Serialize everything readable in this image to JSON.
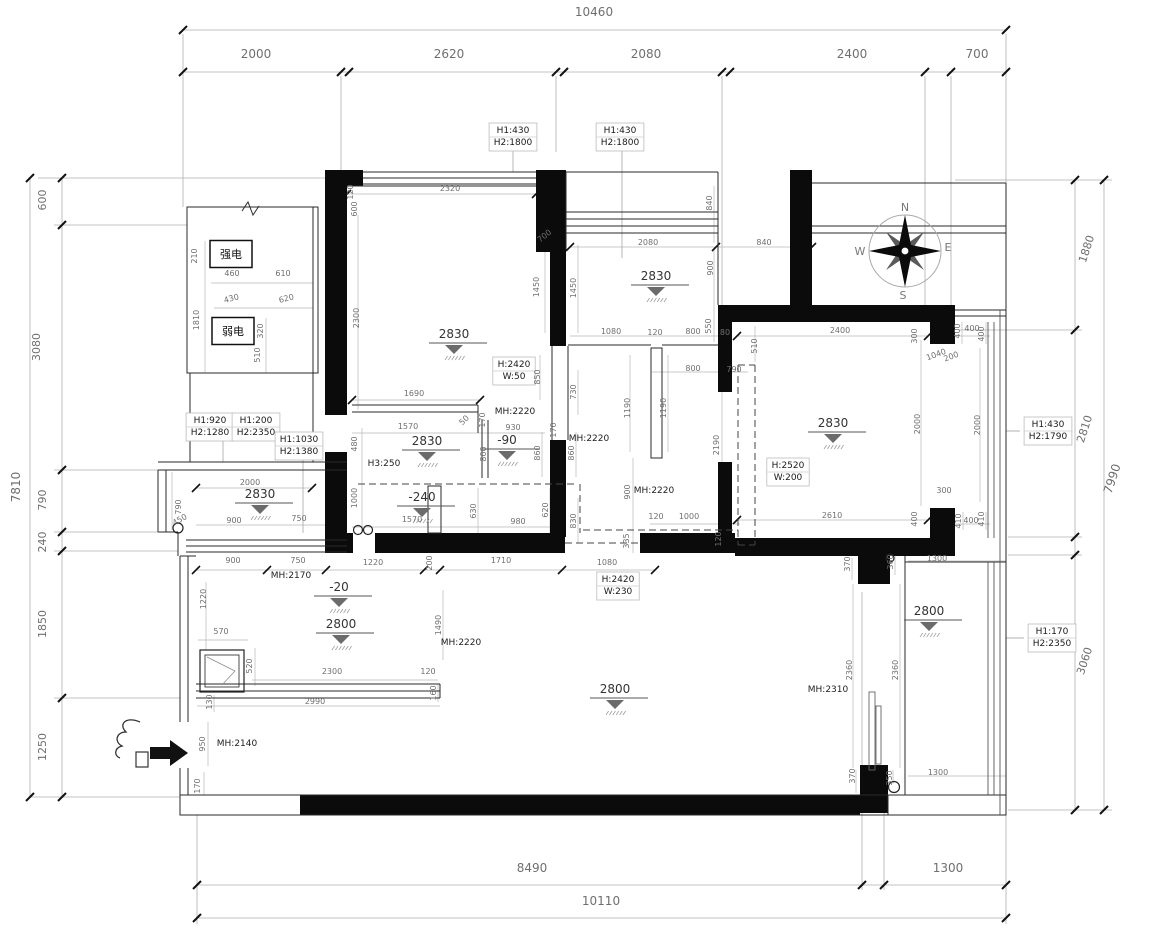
{
  "drawing": {
    "type": "residential floor plan with dimensions",
    "units": "mm"
  },
  "compass": {
    "n": "N",
    "s": "S",
    "e": "E",
    "w": "W"
  },
  "electric_boxes": [
    {
      "label": "强电",
      "x": 231,
      "y": 254,
      "w": 42,
      "h": 27
    },
    {
      "label": "弱电",
      "x": 233,
      "y": 331,
      "w": 42,
      "h": 27
    }
  ],
  "boxed_labels": [
    {
      "lines": [
        "H1:430",
        "H2:1800"
      ],
      "x": 513,
      "y": 137
    },
    {
      "lines": [
        "H1:430",
        "H2:1800"
      ],
      "x": 620,
      "y": 137
    },
    {
      "lines": [
        "H1:920",
        "H2:1280"
      ],
      "x": 210,
      "y": 427
    },
    {
      "lines": [
        "H1:200",
        "H2:2350"
      ],
      "x": 256,
      "y": 427
    },
    {
      "lines": [
        "H1:1030",
        "H2:1380"
      ],
      "x": 299,
      "y": 446
    },
    {
      "lines": [
        "H1:430",
        "H2:1790"
      ],
      "x": 1048,
      "y": 431
    },
    {
      "lines": [
        "H1:170",
        "H2:2350"
      ],
      "x": 1052,
      "y": 638
    },
    {
      "lines": [
        "H:2420",
        "W:50"
      ],
      "x": 514,
      "y": 371
    },
    {
      "lines": [
        "H:2420",
        "W:230"
      ],
      "x": 618,
      "y": 586
    },
    {
      "lines": [
        "H:2520",
        "W:200"
      ],
      "x": 788,
      "y": 472
    }
  ],
  "elevations": [
    {
      "t": "2830",
      "x": 454,
      "y": 338
    },
    {
      "t": "2830",
      "x": 656,
      "y": 280
    },
    {
      "t": "2830",
      "x": 833,
      "y": 427
    },
    {
      "t": "2830",
      "x": 260,
      "y": 498
    },
    {
      "t": "2830",
      "x": 427,
      "y": 445
    },
    {
      "t": "-90",
      "x": 507,
      "y": 444
    },
    {
      "t": "-240",
      "x": 422,
      "y": 501
    },
    {
      "t": "-20",
      "x": 339,
      "y": 591
    },
    {
      "t": "2800",
      "x": 341,
      "y": 628
    },
    {
      "t": "2800",
      "x": 615,
      "y": 693
    },
    {
      "t": "2800",
      "x": 929,
      "y": 615
    }
  ],
  "dim_labels": [
    {
      "t": "10460",
      "x": 594,
      "y": 16,
      "s": 12
    },
    {
      "t": "2000",
      "x": 256,
      "y": 58,
      "s": 12
    },
    {
      "t": "2620",
      "x": 449,
      "y": 58,
      "s": 12
    },
    {
      "t": "2080",
      "x": 646,
      "y": 58,
      "s": 12
    },
    {
      "t": "2400",
      "x": 852,
      "y": 58,
      "s": 12
    },
    {
      "t": "700",
      "x": 977,
      "y": 58,
      "s": 12
    },
    {
      "t": "7810",
      "x": 20,
      "y": 487,
      "r": -90,
      "s": 12
    },
    {
      "t": "600",
      "x": 46,
      "y": 200,
      "r": -90,
      "s": 11
    },
    {
      "t": "3080",
      "x": 40,
      "y": 347,
      "r": -90,
      "s": 11
    },
    {
      "t": "790",
      "x": 46,
      "y": 500,
      "r": -90,
      "s": 11
    },
    {
      "t": "240",
      "x": 46,
      "y": 542,
      "r": -90,
      "s": 11
    },
    {
      "t": "1850",
      "x": 46,
      "y": 624,
      "r": -90,
      "s": 11
    },
    {
      "t": "1250",
      "x": 46,
      "y": 747,
      "r": -90,
      "s": 11
    },
    {
      "t": "1880",
      "x": 1090,
      "y": 250,
      "r": -72,
      "s": 11
    },
    {
      "t": "2810",
      "x": 1088,
      "y": 430,
      "r": -72,
      "s": 11
    },
    {
      "t": "7990",
      "x": 1116,
      "y": 480,
      "r": -72,
      "s": 12
    },
    {
      "t": "3060",
      "x": 1088,
      "y": 662,
      "r": -72,
      "s": 11
    },
    {
      "t": "8490",
      "x": 532,
      "y": 872,
      "s": 12
    },
    {
      "t": "1300",
      "x": 948,
      "y": 872,
      "s": 12
    },
    {
      "t": "10110",
      "x": 601,
      "y": 905,
      "s": 12
    },
    {
      "t": "210",
      "x": 197,
      "y": 256,
      "r": -90
    },
    {
      "t": "1810",
      "x": 199,
      "y": 320,
      "r": -90
    },
    {
      "t": "460",
      "x": 232,
      "y": 276
    },
    {
      "t": "610",
      "x": 283,
      "y": 276
    },
    {
      "t": "430",
      "x": 232,
      "y": 301,
      "r": -15
    },
    {
      "t": "620",
      "x": 287,
      "y": 301,
      "r": -15
    },
    {
      "t": "320",
      "x": 263,
      "y": 331,
      "r": -90
    },
    {
      "t": "510",
      "x": 260,
      "y": 355,
      "r": -90
    },
    {
      "t": "120",
      "x": 353,
      "y": 192,
      "r": -90
    },
    {
      "t": "600",
      "x": 357,
      "y": 209,
      "r": -90
    },
    {
      "t": "2320",
      "x": 450,
      "y": 191
    },
    {
      "t": "2300",
      "x": 359,
      "y": 318,
      "r": -90
    },
    {
      "t": "1450",
      "x": 539,
      "y": 287,
      "r": -90
    },
    {
      "t": "1450",
      "x": 576,
      "y": 288,
      "r": -90
    },
    {
      "t": "700",
      "x": 546,
      "y": 238,
      "r": -38
    },
    {
      "t": "850",
      "x": 540,
      "y": 377,
      "r": -90
    },
    {
      "t": "730",
      "x": 576,
      "y": 392,
      "r": -90
    },
    {
      "t": "1690",
      "x": 414,
      "y": 396
    },
    {
      "t": "1570",
      "x": 408,
      "y": 429
    },
    {
      "t": "50",
      "x": 466,
      "y": 422,
      "r": -45
    },
    {
      "t": "170",
      "x": 485,
      "y": 420,
      "r": -90
    },
    {
      "t": "930",
      "x": 513,
      "y": 430
    },
    {
      "t": "170",
      "x": 556,
      "y": 430,
      "r": -90
    },
    {
      "t": "480",
      "x": 357,
      "y": 444,
      "r": -90
    },
    {
      "t": "800",
      "x": 486,
      "y": 454,
      "r": -90
    },
    {
      "t": "860",
      "x": 540,
      "y": 453,
      "r": -90
    },
    {
      "t": "860",
      "x": 574,
      "y": 453,
      "r": -90
    },
    {
      "t": "1000",
      "x": 357,
      "y": 498,
      "r": -90
    },
    {
      "t": "630",
      "x": 476,
      "y": 511,
      "r": -90
    },
    {
      "t": "620",
      "x": 548,
      "y": 510,
      "r": -90
    },
    {
      "t": "980",
      "x": 518,
      "y": 524
    },
    {
      "t": "1570",
      "x": 412,
      "y": 522
    },
    {
      "t": "830",
      "x": 576,
      "y": 521,
      "r": -90
    },
    {
      "t": "H3:250",
      "x": 384,
      "y": 466,
      "s": 9,
      "c": "#222"
    },
    {
      "t": "840",
      "x": 712,
      "y": 203,
      "r": -90
    },
    {
      "t": "2080",
      "x": 648,
      "y": 245
    },
    {
      "t": "840",
      "x": 764,
      "y": 245
    },
    {
      "t": "900",
      "x": 713,
      "y": 268,
      "r": -90
    },
    {
      "t": "550",
      "x": 711,
      "y": 326,
      "r": -90
    },
    {
      "t": "1080",
      "x": 611,
      "y": 334
    },
    {
      "t": "120",
      "x": 655,
      "y": 335
    },
    {
      "t": "800",
      "x": 693,
      "y": 334
    },
    {
      "t": "80",
      "x": 725,
      "y": 335
    },
    {
      "t": "510",
      "x": 757,
      "y": 346,
      "r": -90
    },
    {
      "t": "800",
      "x": 693,
      "y": 371
    },
    {
      "t": "790",
      "x": 734,
      "y": 372
    },
    {
      "t": "1190",
      "x": 630,
      "y": 408,
      "r": -90
    },
    {
      "t": "1190",
      "x": 666,
      "y": 408,
      "r": -90
    },
    {
      "t": "2190",
      "x": 719,
      "y": 445,
      "r": -90
    },
    {
      "t": "900",
      "x": 630,
      "y": 492,
      "r": -90
    },
    {
      "t": "120",
      "x": 656,
      "y": 519
    },
    {
      "t": "1000",
      "x": 689,
      "y": 519
    },
    {
      "t": "335",
      "x": 629,
      "y": 541,
      "r": -90
    },
    {
      "t": "120",
      "x": 721,
      "y": 539,
      "r": -90
    },
    {
      "t": "2400",
      "x": 840,
      "y": 333
    },
    {
      "t": "300",
      "x": 917,
      "y": 336,
      "r": -90
    },
    {
      "t": "400",
      "x": 960,
      "y": 331,
      "r": -90
    },
    {
      "t": "400",
      "x": 972,
      "y": 331
    },
    {
      "t": "400",
      "x": 984,
      "y": 334,
      "r": -90
    },
    {
      "t": "1040",
      "x": 937,
      "y": 357,
      "r": -20
    },
    {
      "t": "200",
      "x": 952,
      "y": 359,
      "r": -20
    },
    {
      "t": "2000",
      "x": 920,
      "y": 424,
      "r": -90
    },
    {
      "t": "2000",
      "x": 980,
      "y": 425,
      "r": -90
    },
    {
      "t": "2610",
      "x": 832,
      "y": 518
    },
    {
      "t": "300",
      "x": 944,
      "y": 493
    },
    {
      "t": "400",
      "x": 917,
      "y": 519,
      "r": -90
    },
    {
      "t": "410",
      "x": 961,
      "y": 521,
      "r": -90
    },
    {
      "t": "400",
      "x": 971,
      "y": 523
    },
    {
      "t": "410",
      "x": 984,
      "y": 519,
      "r": -90
    },
    {
      "t": "1300",
      "x": 937,
      "y": 561
    },
    {
      "t": "2000",
      "x": 250,
      "y": 485
    },
    {
      "t": "790",
      "x": 181,
      "y": 507,
      "r": -90
    },
    {
      "t": "450",
      "x": 181,
      "y": 522,
      "r": -30
    },
    {
      "t": "900",
      "x": 234,
      "y": 523
    },
    {
      "t": "750",
      "x": 299,
      "y": 521
    },
    {
      "t": "900",
      "x": 233,
      "y": 563
    },
    {
      "t": "750",
      "x": 298,
      "y": 563
    },
    {
      "t": "1220",
      "x": 373,
      "y": 565
    },
    {
      "t": "200",
      "x": 432,
      "y": 563,
      "r": -90
    },
    {
      "t": "1710",
      "x": 501,
      "y": 563
    },
    {
      "t": "1080",
      "x": 607,
      "y": 565
    },
    {
      "t": "1220",
      "x": 206,
      "y": 599,
      "r": -90
    },
    {
      "t": "570",
      "x": 221,
      "y": 634
    },
    {
      "t": "520",
      "x": 252,
      "y": 666,
      "r": -90
    },
    {
      "t": "2300",
      "x": 332,
      "y": 674
    },
    {
      "t": "120",
      "x": 428,
      "y": 674
    },
    {
      "t": "160",
      "x": 436,
      "y": 693,
      "r": -90
    },
    {
      "t": "2990",
      "x": 315,
      "y": 704
    },
    {
      "t": "130",
      "x": 212,
      "y": 702,
      "r": -90
    },
    {
      "t": "1490",
      "x": 441,
      "y": 625,
      "r": -90
    },
    {
      "t": "950",
      "x": 205,
      "y": 744,
      "r": -90
    },
    {
      "t": "170",
      "x": 200,
      "y": 786,
      "r": -90
    },
    {
      "t": "370",
      "x": 850,
      "y": 564,
      "r": -90
    },
    {
      "t": "360",
      "x": 893,
      "y": 562,
      "r": -90
    },
    {
      "t": "2360",
      "x": 852,
      "y": 670,
      "r": -90
    },
    {
      "t": "2360",
      "x": 898,
      "y": 670,
      "r": -90
    },
    {
      "t": "370",
      "x": 855,
      "y": 776,
      "r": -90
    },
    {
      "t": "350",
      "x": 892,
      "y": 778,
      "r": -90
    },
    {
      "t": "1300",
      "x": 938,
      "y": 775
    },
    {
      "t": "MH:2220",
      "x": 515,
      "y": 414,
      "s": 9,
      "c": "#222"
    },
    {
      "t": "MH:2220",
      "x": 589,
      "y": 441,
      "s": 9,
      "c": "#222"
    },
    {
      "t": "MH:2220",
      "x": 654,
      "y": 493,
      "s": 9,
      "c": "#222"
    },
    {
      "t": "MH:2220",
      "x": 461,
      "y": 645,
      "s": 9,
      "c": "#222"
    },
    {
      "t": "MH:2170",
      "x": 291,
      "y": 578,
      "s": 9,
      "c": "#222"
    },
    {
      "t": "MH:2140",
      "x": 237,
      "y": 746,
      "s": 9,
      "c": "#222"
    },
    {
      "t": "MH:2310",
      "x": 828,
      "y": 692,
      "s": 9,
      "c": "#222"
    }
  ]
}
